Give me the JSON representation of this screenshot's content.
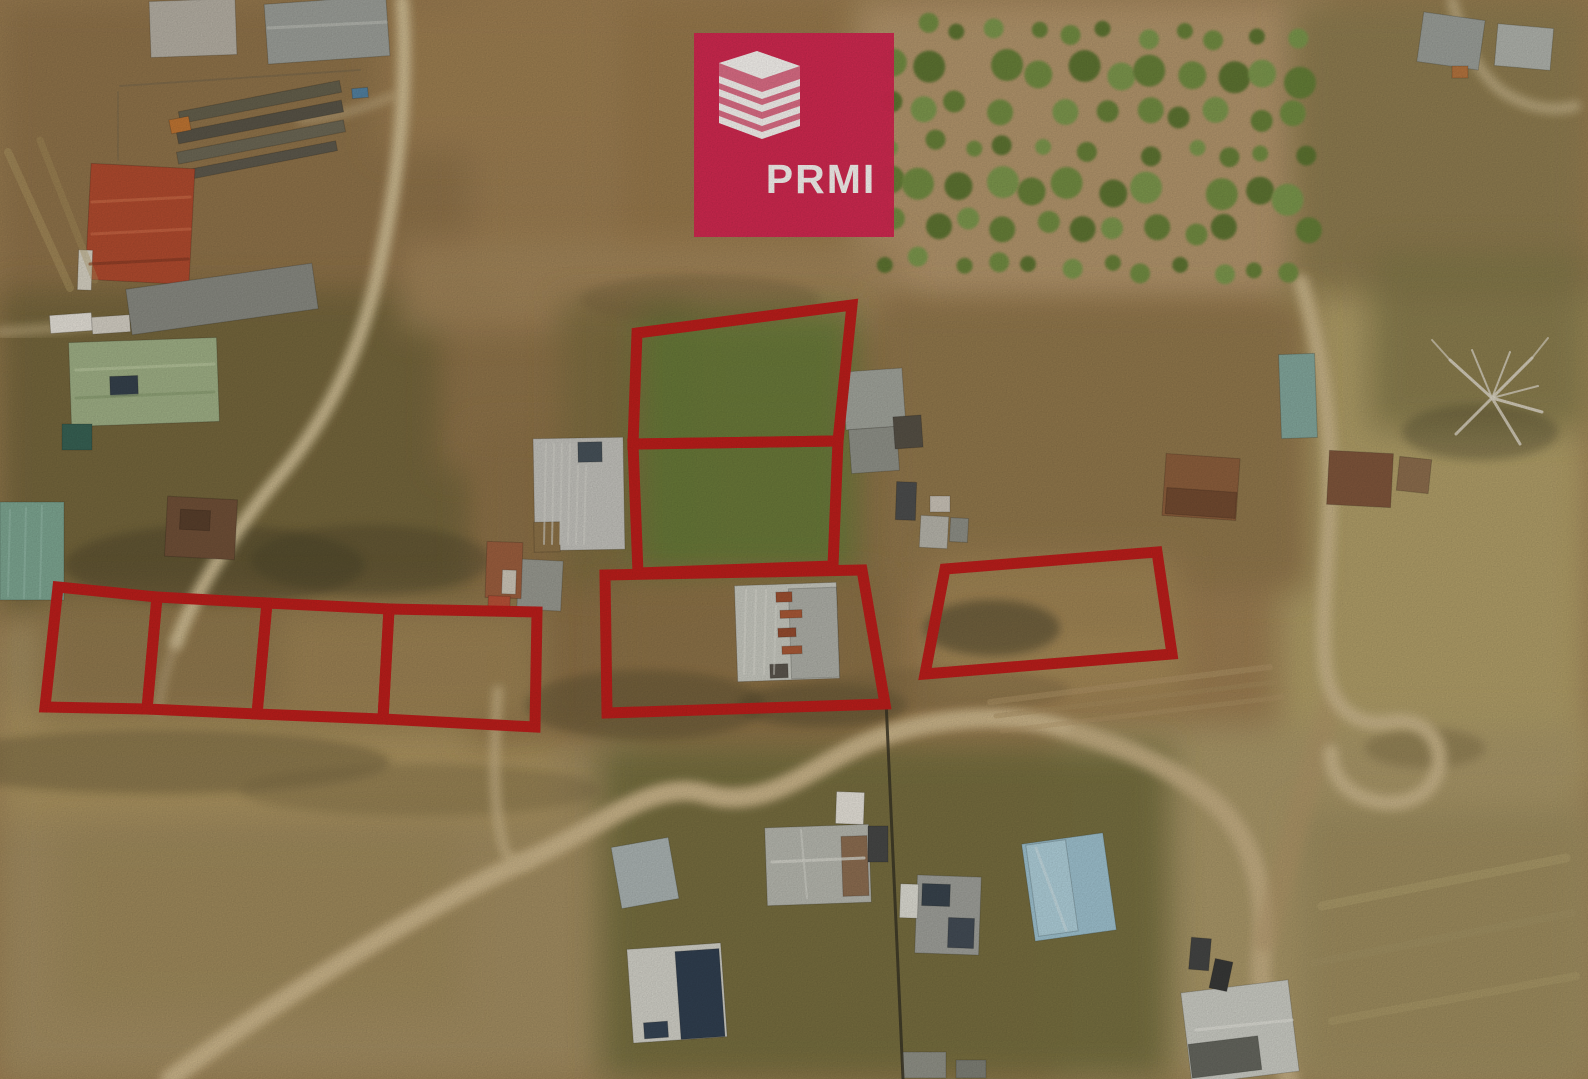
{
  "logo": {
    "text": "PRMI",
    "background_color": "#d41e4e",
    "icon": "stacked-building-icon",
    "icon_color": "#ffffff"
  },
  "annotations": {
    "outline_color": "#bd1515",
    "outline_width": 11,
    "parcels": [
      {
        "id": "parcel-upper-middle",
        "points": "637,333 852,305 838,441 633,444"
      },
      {
        "id": "parcel-lower-middle",
        "points": "633,444 838,441 833,566 638,573"
      },
      {
        "id": "parcel-house",
        "points": "605,575 862,570 885,704 607,713"
      },
      {
        "id": "parcel-right",
        "points": "945,569 1157,552 1172,654 925,674"
      },
      {
        "id": "parcel-row-1",
        "points": "58,587 157,597 147,709 45,707"
      },
      {
        "id": "parcel-row-2",
        "points": "157,597 267,603 257,714 147,709"
      },
      {
        "id": "parcel-row-3",
        "points": "267,603 389,609 383,719 257,714"
      },
      {
        "id": "parcel-row-4",
        "points": "389,609 537,612 535,727 383,719"
      }
    ]
  }
}
